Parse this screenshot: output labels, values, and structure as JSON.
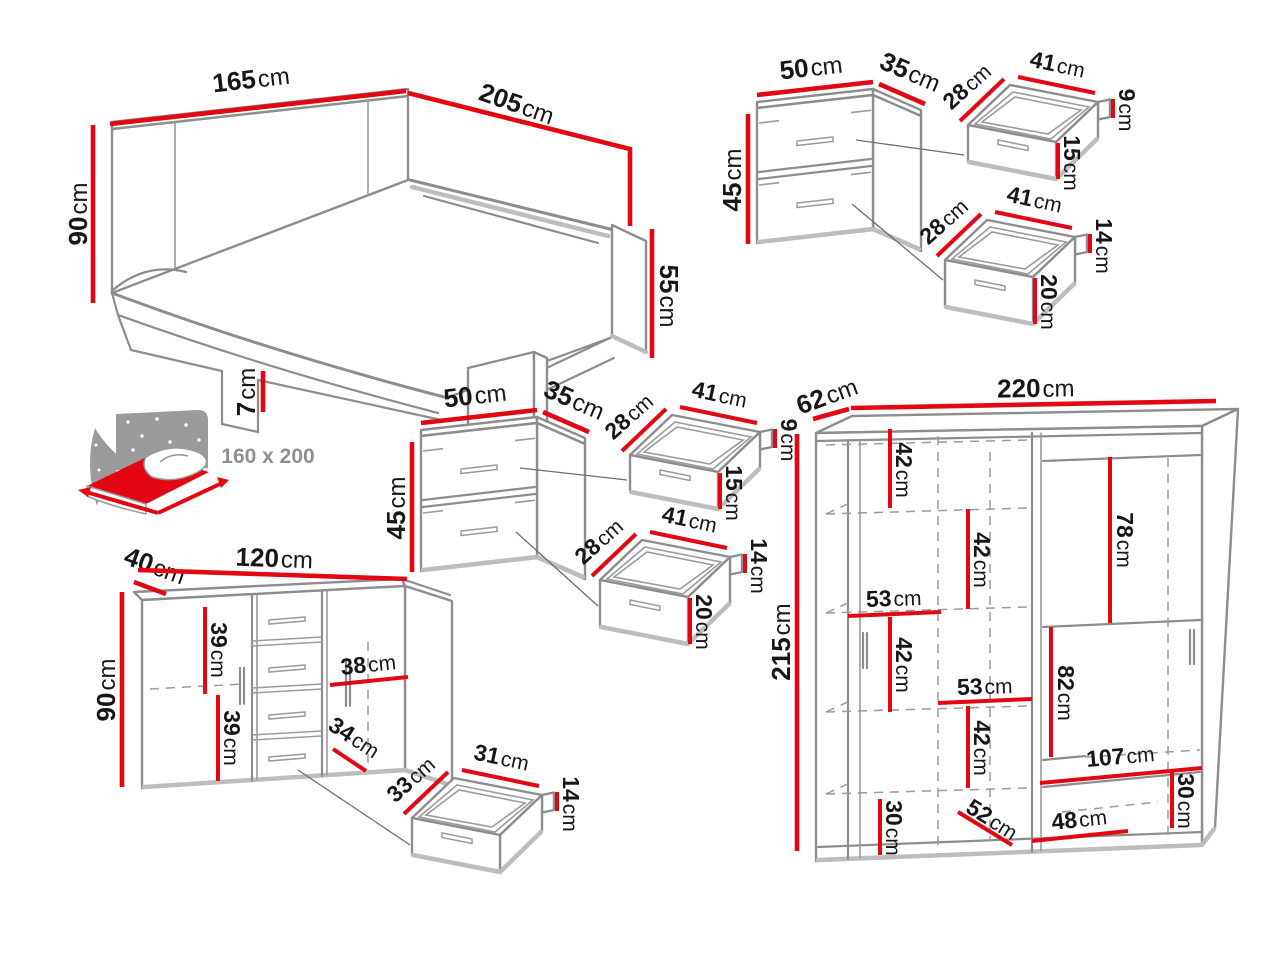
{
  "units": {
    "cm": "cm"
  },
  "colors": {
    "dimension_red": "#e30613",
    "outline_gray": "#8d8d8d",
    "outline_light": "#bdbdbd",
    "label_black": "#171717",
    "muted_gray": "#8f8f8f",
    "background": "#ffffff"
  },
  "bed": {
    "width": "165",
    "length": "205",
    "headboard_height": "90",
    "foot_height": "55",
    "leg_height": "7"
  },
  "bed_icon": {
    "mattress_size": "160 x 200"
  },
  "nightstands": [
    {
      "width": "50",
      "depth": "35",
      "height": "45",
      "upper_drawer": {
        "depth": "28",
        "width": "41",
        "back_height": "9",
        "front_height": "15"
      },
      "lower_drawer": {
        "depth": "28",
        "width": "41",
        "back_height": "14",
        "front_height": "20"
      }
    },
    {
      "width": "50",
      "depth": "35",
      "height": "45",
      "upper_drawer": {
        "depth": "28",
        "width": "41",
        "back_height": "9",
        "front_height": "15"
      },
      "lower_drawer": {
        "depth": "28",
        "width": "41",
        "back_height": "14",
        "front_height": "20"
      }
    }
  ],
  "dresser": {
    "depth": "40",
    "width": "120",
    "height": "90",
    "inner_top": "39",
    "inner_bottom": "39",
    "inner_right_width": "38",
    "inner_drawer_width": "34",
    "drawer": {
      "depth": "33",
      "width": "31",
      "height": "14"
    }
  },
  "wardrobe": {
    "depth": "62",
    "width": "220",
    "height": "215",
    "inner": {
      "top_shelf": "42",
      "middle_shelf": "42",
      "left_section_width": "53",
      "lower_shelf": "42",
      "lower_section_width": "53",
      "bottom_shelf": "42",
      "right_upper_height": "78",
      "right_middle_height": "82",
      "bottom_shelf_width": "107",
      "bottom_right_height": "30",
      "bottom_left_height": "30",
      "bottom_depth": "52",
      "bottom_drawer_width": "48"
    }
  }
}
